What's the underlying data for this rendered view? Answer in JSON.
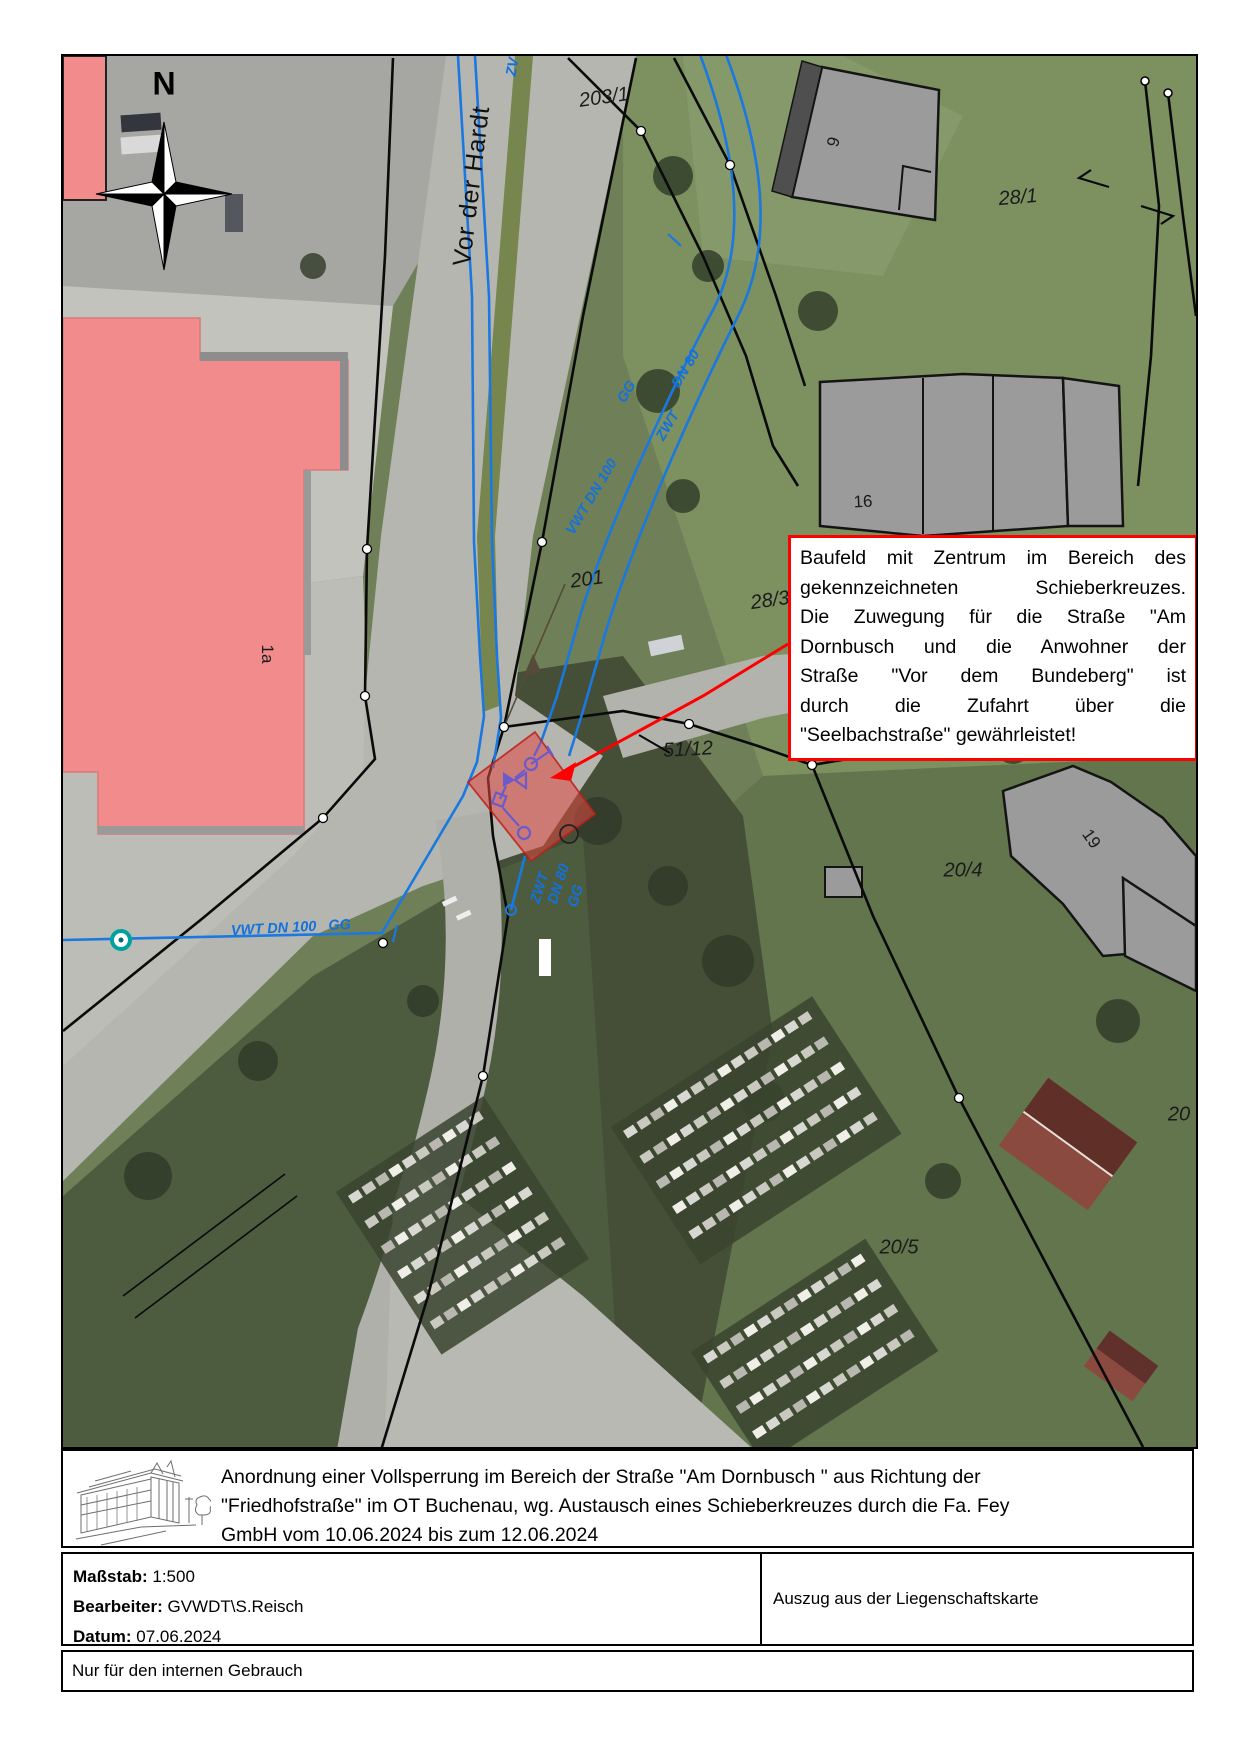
{
  "map": {
    "north_label": "N",
    "street_label": {
      "text": "Vor der Hardt",
      "x": 409,
      "y": 130,
      "rot": -83
    },
    "annotation_box": {
      "lines": [
        "Baufeld mit Zentrum im Bereich des",
        "gekennzeichneten Schieberkreuzes.",
        "Die Zuwegung für die Straße \"Am",
        "Dornbusch und die Anwohner der",
        "Straße \"Vor dem Bundeberg\" ist",
        "durch die Zufahrt über die",
        "\"Seelbachstraße\" gewährleistet!"
      ]
    },
    "parcel_labels": [
      {
        "text": "203/1",
        "x": 541,
        "y": 42,
        "rot": -8,
        "cls": "lbl-parcel"
      },
      {
        "text": "28/1",
        "x": 955,
        "y": 142,
        "rot": -5,
        "cls": "lbl-parcel"
      },
      {
        "text": "9",
        "x": 771,
        "y": 86,
        "rot": -75,
        "cls": "lbl-house"
      },
      {
        "text": "16",
        "x": 800,
        "y": 446,
        "rot": -3,
        "cls": "lbl-house"
      },
      {
        "text": "28/3",
        "x": 707,
        "y": 545,
        "rot": -8,
        "cls": "lbl-parcel"
      },
      {
        "text": "201",
        "x": 524,
        "y": 524,
        "rot": -8,
        "cls": "lbl-parcel"
      },
      {
        "text": "51/12",
        "x": 625,
        "y": 694,
        "rot": -3,
        "cls": "lbl-parcel"
      },
      {
        "text": "51/18",
        "x": 825,
        "y": 697,
        "rot": -3,
        "cls": "lbl-parcel"
      },
      {
        "text": "20/4",
        "x": 900,
        "y": 815,
        "rot": 0,
        "cls": "lbl-parcel"
      },
      {
        "text": "19",
        "x": 1028,
        "y": 783,
        "rot": 55,
        "cls": "lbl-house"
      },
      {
        "text": "20/5",
        "x": 836,
        "y": 1192,
        "rot": 0,
        "cls": "lbl-parcel"
      },
      {
        "text": "20",
        "x": 1116,
        "y": 1059,
        "rot": 0,
        "cls": "lbl-parcel"
      },
      {
        "text": "1a",
        "x": 204,
        "y": 598,
        "rot": 90,
        "cls": "lbl-house"
      }
    ],
    "pipe_labels": [
      {
        "text": "VWT DN 100",
        "x": 529,
        "y": 441,
        "rot": -59
      },
      {
        "text": "GG",
        "x": 564,
        "y": 336,
        "rot": -59
      },
      {
        "text": "ZWT",
        "x": 605,
        "y": 370,
        "rot": -59
      },
      {
        "text": "DN 80",
        "x": 623,
        "y": 313,
        "rot": -59
      },
      {
        "text": "VWT DN 100   GG",
        "x": 228,
        "y": 872,
        "rot": -3
      },
      {
        "text": "ZWT",
        "x": 477,
        "y": 832,
        "rot": -72
      },
      {
        "text": "DN 80",
        "x": 496,
        "y": 828,
        "rot": -72
      },
      {
        "text": "GG",
        "x": 513,
        "y": 840,
        "rot": -72
      },
      {
        "text": "ZV",
        "x": 450,
        "y": 11,
        "rot": -80
      }
    ]
  },
  "footer": {
    "title_lines": [
      "Anordnung einer Vollsperrung im Bereich der Straße \"Am Dornbusch \" aus Richtung der",
      "\"Friedhofstraße\" im OT Buchenau, wg. Austausch eines Schieberkreuzes durch die Fa. Fey",
      "GmbH vom 10.06.2024 bis zum 12.06.2024"
    ],
    "meta": {
      "scale_label": "Maßstab:",
      "scale_value": "1:500",
      "editor_label": "Bearbeiter:",
      "editor_value": "GVWDT\\S.Reisch",
      "date_label": "Datum:",
      "date_value": "07.06.2024",
      "right_text": "Auszug aus der Liegenschaftskarte"
    },
    "note": "Nur für den internen Gebrauch"
  },
  "colors": {
    "annotation_border": "#ff0000",
    "baufeld_fill": "#e24841",
    "pipe_blue": "#1a79e0",
    "building_pink": "#f28c8c",
    "building_gray": "#9b9b9b",
    "hydrant_teal": "#00a0a0"
  }
}
